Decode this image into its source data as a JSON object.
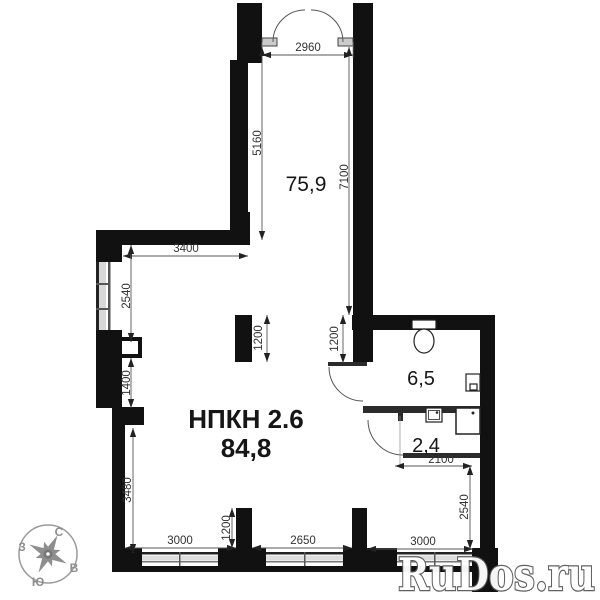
{
  "unit": {
    "name": "НПКН 2.6",
    "area": "84,8"
  },
  "rooms": {
    "hall_area": "75,9",
    "bath_area": "6,5",
    "wc_area": "2,4"
  },
  "dims": [
    "2960",
    "5160",
    "7100",
    "3400",
    "2540",
    "1400",
    "3480",
    "1200",
    "1200",
    "3000",
    "1200",
    "2650",
    "3000",
    "2540",
    "2100"
  ],
  "compass": {
    "n": "С",
    "e": "В",
    "s": "Ю",
    "w": "З"
  },
  "watermark": {
    "text": "RuDos.ru"
  },
  "colors": {
    "wall": "#111111",
    "partition": "#2b2b2b",
    "dim_line": "#555555",
    "compass": "#8e8e8e"
  }
}
